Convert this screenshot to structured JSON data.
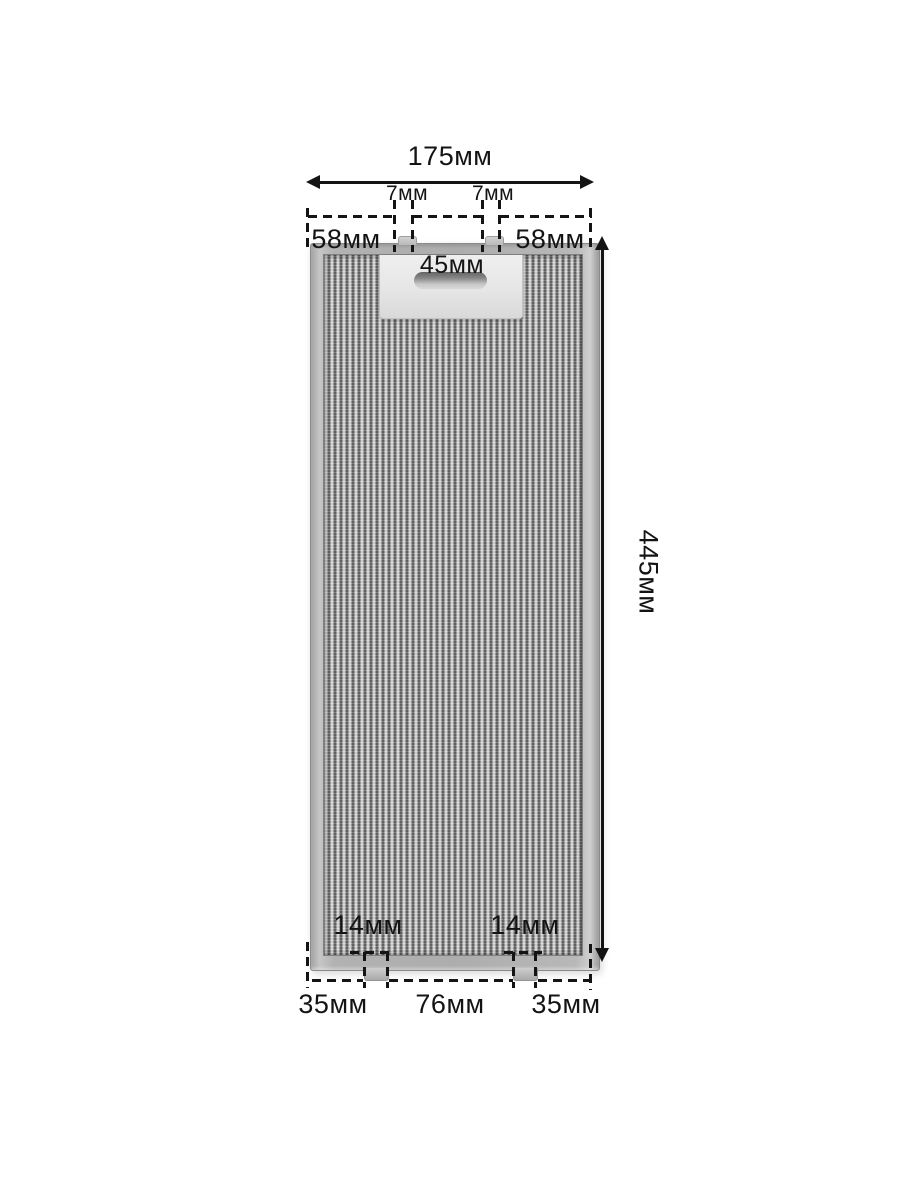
{
  "page": {
    "background": "#ffffff",
    "subject": "aluminium grease filter for cooker hood, dimensional diagram",
    "unit": "мм"
  },
  "dimensions": {
    "top_width": "175мм",
    "top_tab_left": "7мм",
    "top_tab_right": "7мм",
    "top_offset_left": "58мм",
    "top_offset_right": "58мм",
    "handle_width": "45мм",
    "height": "445мм",
    "bottom_tab_left": "14мм",
    "bottom_tab_right": "14мм",
    "bottom_offset_left": "35мм",
    "bottom_center": "76мм",
    "bottom_offset_right": "35мм"
  },
  "colors": {
    "dimension_lines": "#141414",
    "frame": "#b2b2b2",
    "mesh_base": "#a2a2a2",
    "handle_plate": "#e9e9e9",
    "background": "#ffffff"
  }
}
